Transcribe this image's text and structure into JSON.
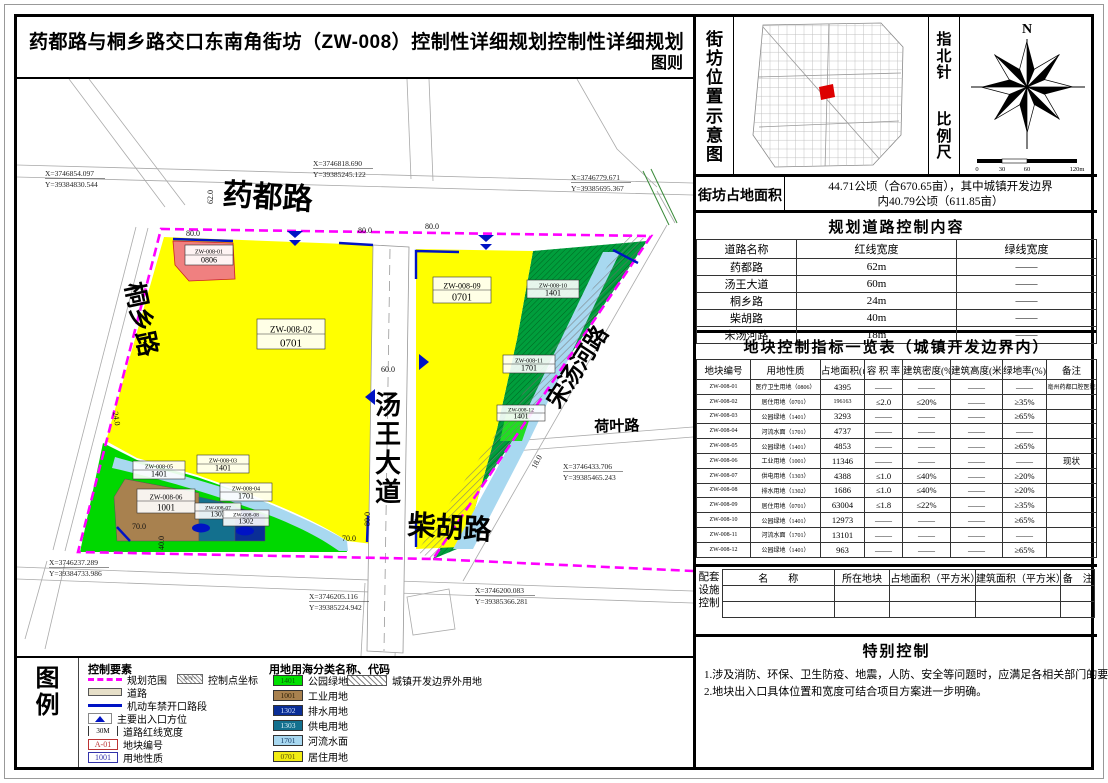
{
  "title": "药都路与桐乡路交口东南角街坊（ZW-008）控制性详细规划控制性详细规划",
  "sheet_kind": "图则",
  "location_panel": {
    "label": "街坊位置示意图",
    "north_label": "指北针",
    "scale_label": "比例尺",
    "north_n": "N",
    "scale_ticks": [
      "0",
      "30",
      "60",
      "120m"
    ]
  },
  "area_row": {
    "label": "街坊占地面积",
    "value_line1": "44.71公顷（合670.65亩），其中城镇开发边界",
    "value_line2": "内40.79公顷（611.85亩）"
  },
  "road_table": {
    "title": "规划道路控制内容",
    "headers": [
      "道路名称",
      "红线宽度",
      "绿线宽度"
    ],
    "rows": [
      [
        "药都路",
        "62m",
        "——"
      ],
      [
        "汤王大道",
        "60m",
        "——"
      ],
      [
        "桐乡路",
        "24m",
        "——"
      ],
      [
        "柴胡路",
        "40m",
        "——"
      ],
      [
        "宋汤河路",
        "18m",
        "——"
      ]
    ]
  },
  "parcel_table": {
    "title": "地块控制指标一览表（城镇开发边界内）",
    "headers": [
      "地块编号",
      "用地性质",
      "占地面积(㎡)",
      "容 积 率",
      "建筑密度(%)",
      "建筑高度(米)",
      "绿地率(%)",
      "备注"
    ],
    "rows": [
      [
        "ZW-008-01",
        "医疗卫生用地（0806）",
        "4395",
        "——",
        "——",
        "——",
        "——",
        "亳州药都口腔医院"
      ],
      [
        "ZW-008-02",
        "居住用地（0701）",
        "196163",
        "≤2.0",
        "≤20%",
        "——",
        "≥35%",
        ""
      ],
      [
        "ZW-008-03",
        "公园绿地（1401）",
        "3293",
        "——",
        "——",
        "——",
        "≥65%",
        ""
      ],
      [
        "ZW-008-04",
        "河流水面（1701）",
        "4737",
        "——",
        "——",
        "——",
        "——",
        ""
      ],
      [
        "ZW-008-05",
        "公园绿地（1401）",
        "4853",
        "——",
        "——",
        "——",
        "≥65%",
        ""
      ],
      [
        "ZW-008-06",
        "工业用地（1001）",
        "11346",
        "——",
        "——",
        "——",
        "——",
        "现状"
      ],
      [
        "ZW-008-07",
        "供电用地（1303）",
        "4388",
        "≤1.0",
        "≤40%",
        "——",
        "≥20%",
        ""
      ],
      [
        "ZW-008-08",
        "排水用地（1302）",
        "1686",
        "≤1.0",
        "≤40%",
        "——",
        "≥20%",
        ""
      ],
      [
        "ZW-008-09",
        "居住用地（0701）",
        "63004",
        "≤1.8",
        "≤22%",
        "——",
        "≥35%",
        ""
      ],
      [
        "ZW-008-10",
        "公园绿地（1401）",
        "12973",
        "——",
        "——",
        "——",
        "≥65%",
        ""
      ],
      [
        "ZW-008-11",
        "河流水面（1701）",
        "13101",
        "——",
        "——",
        "——",
        "——",
        ""
      ],
      [
        "ZW-008-12",
        "公园绿地（1401）",
        "963",
        "——",
        "——",
        "——",
        "≥65%",
        ""
      ]
    ]
  },
  "facility_table": {
    "side_label": [
      "配套",
      "设施",
      "控制"
    ],
    "headers": [
      "名　　称",
      "所在地块",
      "占地面积（平方米）",
      "建筑面积（平方米）",
      "备　注"
    ],
    "empty_rows": 2
  },
  "special_control": {
    "title": "特别控制",
    "notes": [
      "1.涉及消防、环保、卫生防疫、地震，人防、安全等问题时，应满足各相关部门的要求。",
      "2.地块出入口具体位置和宽度可结合项目方案进一步明确。"
    ]
  },
  "legend": {
    "title": [
      "图",
      "例"
    ],
    "control_title": "控制要素",
    "control_items": [
      {
        "type": "boundary",
        "label": "规划范围"
      },
      {
        "type": "road",
        "label": "道路"
      },
      {
        "type": "noaccess",
        "label": "机动车禁开口路段"
      },
      {
        "type": "entrance",
        "label": "主要出入口方位"
      },
      {
        "type": "redline",
        "label": "道路红线宽度",
        "swatch_text": "30M"
      },
      {
        "type": "plot-code",
        "label": "地块编号",
        "swatch_text": "A-01"
      },
      {
        "type": "use-code",
        "label": "用地性质",
        "swatch_text": "1001"
      }
    ],
    "control_point": {
      "label": "控制点坐标",
      "swatch_text": "X=Y="
    },
    "landuse_title": "用地用海分类名称、代码",
    "landuse_items": [
      {
        "code": "1401",
        "label": "公园绿地",
        "color": "#00e000",
        "text_color": "#045a04"
      },
      {
        "code": "1001",
        "label": "工业用地",
        "color": "#a8814f",
        "text_color": "#2e2008"
      },
      {
        "code": "1302",
        "label": "排水用地",
        "color": "#0a2e96",
        "text_color": "#cfe0ff"
      },
      {
        "code": "1303",
        "label": "供电用地",
        "color": "#13708e",
        "text_color": "#dff2fa"
      },
      {
        "code": "1701",
        "label": "河流水面",
        "color": "#a8d8f0",
        "text_color": "#123a66"
      },
      {
        "code": "0701",
        "label": "居住用地",
        "color": "#f2ec12",
        "text_color": "#554e06"
      }
    ],
    "outside_item": {
      "label": "城镇开发边界外用地"
    }
  },
  "map": {
    "road_labels": {
      "yaodu": "药都路",
      "tongxiang": "桐乡路",
      "tangwang": "汤王大道",
      "chaihu": "柴胡路",
      "songtanghe": "宋汤河路",
      "heye": "荷叶路"
    },
    "coordinates": {
      "c1": [
        "X=3746854.097",
        "Y=39384830.544"
      ],
      "c2": [
        "X=3746818.690",
        "Y=39385245.122"
      ],
      "c3": [
        "X=3746779.671",
        "Y=39385695.367"
      ],
      "c4": [
        "X=3746433.706",
        "Y=39385465.243"
      ],
      "c5": [
        "X=3746237.289",
        "Y=39384733.986"
      ],
      "c6": [
        "X=3746205.116",
        "Y=39385224.942"
      ],
      "c7": [
        "X=3746200.083",
        "Y=39385366.281"
      ]
    },
    "dimensions": {
      "d62": "62.0",
      "d80a": "80.0",
      "d80b": "80.0",
      "d80c": "80.0",
      "d60": "60.0",
      "d24": "24.0",
      "d40": "40.0",
      "d70a": "70.0",
      "d70b": "70.0",
      "d80d": "80.0",
      "d18": "18.0"
    },
    "parcels": {
      "p1": [
        "ZW-008-01",
        "0806"
      ],
      "p2": [
        "ZW-008-02",
        "0701"
      ],
      "p3": [
        "ZW-008-03",
        "1401"
      ],
      "p4": [
        "ZW-008-04",
        "1701"
      ],
      "p5": [
        "ZW-008-05",
        "1401"
      ],
      "p6": [
        "ZW-008-06",
        "1001"
      ],
      "p7": [
        "ZW-008-07",
        "1303"
      ],
      "p8": [
        "ZW-008-08",
        "1302"
      ],
      "p9": [
        "ZW-008-09",
        "0701"
      ],
      "p10": [
        "ZW-008-10",
        "1401"
      ],
      "p11": [
        "ZW-008-11",
        "1701"
      ],
      "p12": [
        "ZW-008-12",
        "1401"
      ]
    }
  },
  "colors": {
    "boundary": "#ff00ff",
    "residential": "#ffff00",
    "park_green": "#00d800",
    "park_green_dark": "#009e3c",
    "industrial": "#a8814f",
    "water": "#a8d8f0",
    "drainage": "#0a2e96",
    "power": "#13708e",
    "medical": "#f08080",
    "no_access": "#0013c4"
  }
}
